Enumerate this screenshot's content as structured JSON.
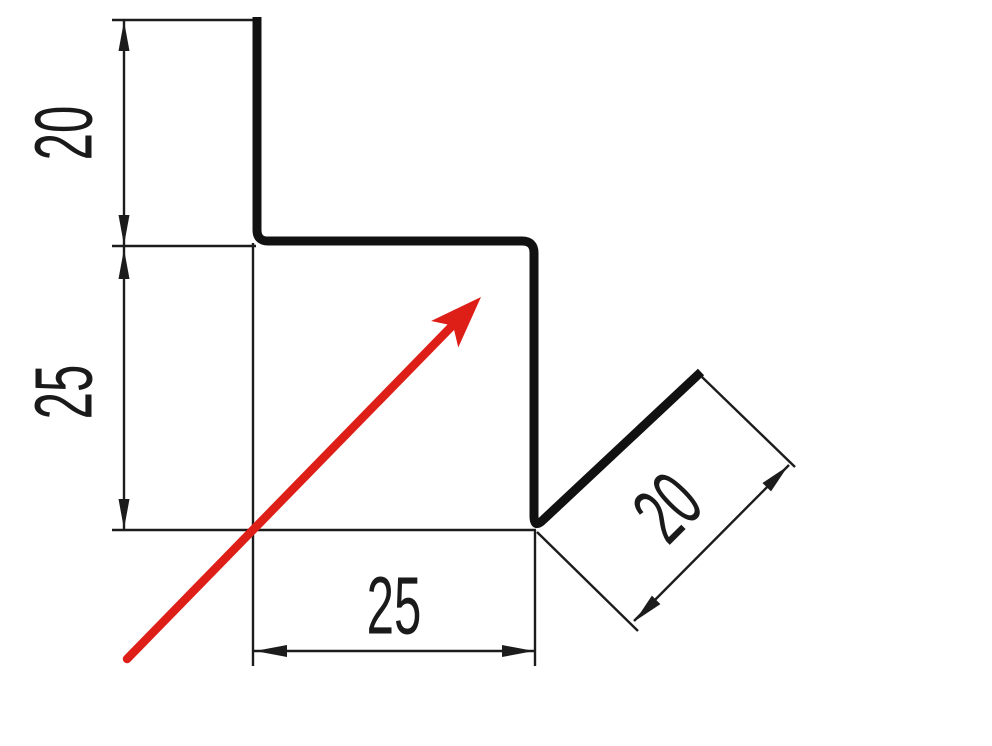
{
  "drawing": {
    "name": "sheet-metal-profile-technical-drawing",
    "colors": {
      "line": "#1c1c1c",
      "profile": "#111111",
      "accent_red": "#de1f18",
      "background": "#ffffff"
    },
    "dimensions": {
      "top_height": {
        "label": "20"
      },
      "left_height": {
        "label": "25"
      },
      "bottom_width": {
        "label": "25"
      },
      "flange_length": {
        "label": "20"
      }
    }
  }
}
